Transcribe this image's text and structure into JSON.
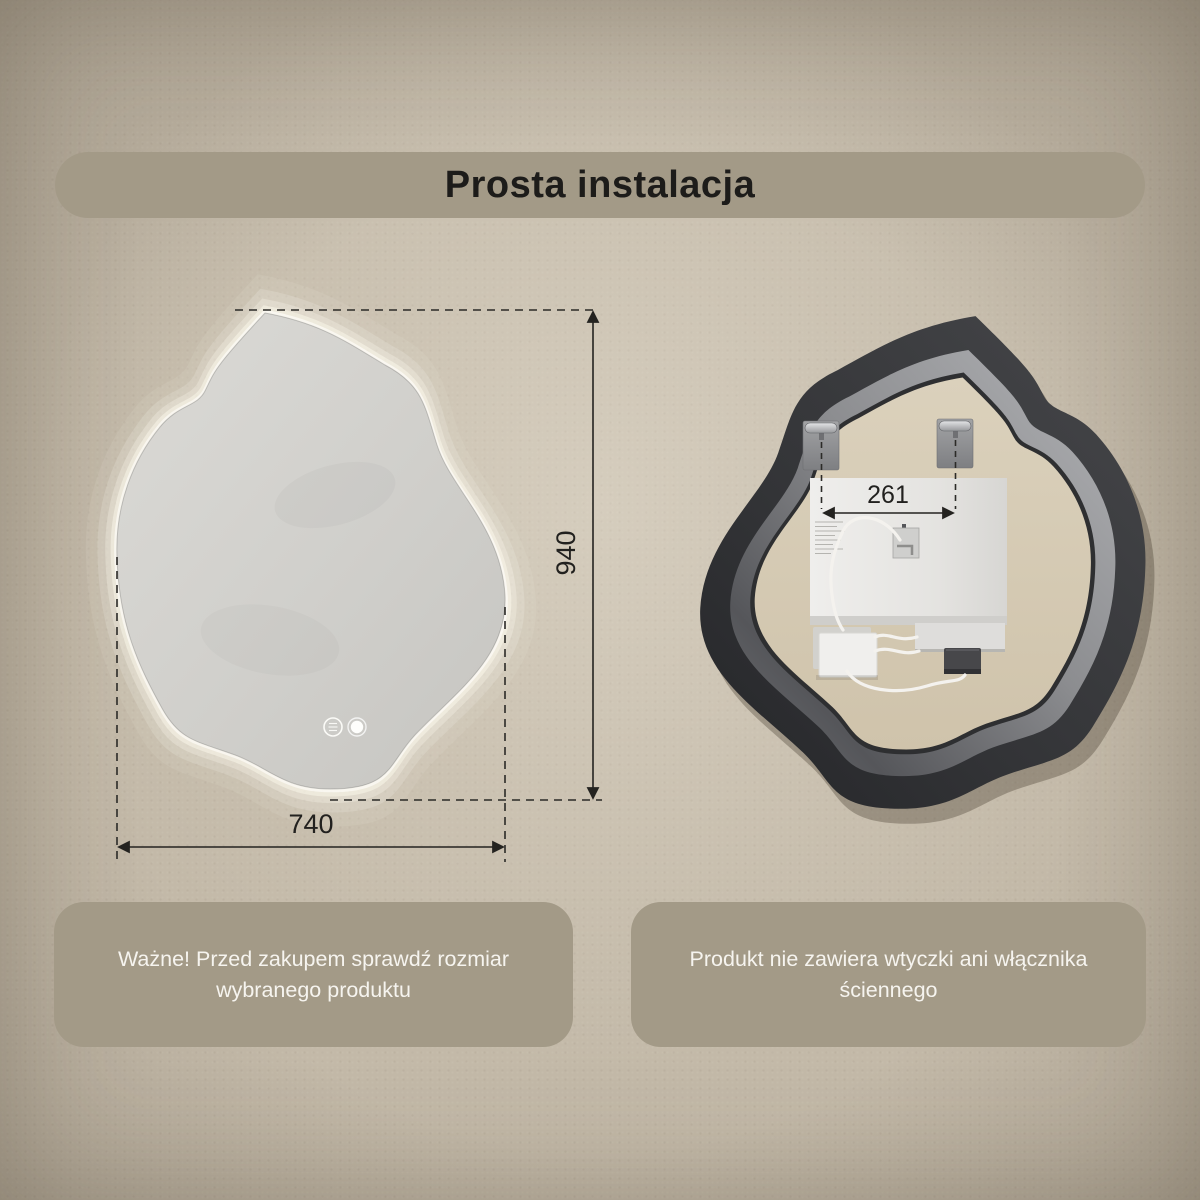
{
  "title": "Prosta instalacja",
  "front_view": {
    "height_label": "940",
    "width_label": "740",
    "touch_buttons": [
      {
        "icon": "antifog-touch-icon"
      },
      {
        "icon": "light-touch-icon"
      }
    ]
  },
  "back_view": {
    "bracket_distance_label": "261"
  },
  "info_boxes": [
    {
      "lines": [
        "Ważne! Przed zakupem sprawdź rozmiar",
        "wybranego produktu"
      ]
    },
    {
      "lines": [
        "Produkt nie zawiera wtyczki ani włącznika",
        "ściennego"
      ]
    }
  ],
  "colors": {
    "wall": "#c3b9a8",
    "banner": "#a39a87",
    "title_text": "#1d1c1a",
    "info_text": "#f6f4ef",
    "dimension_lines": "#242320",
    "mirror_surface": "#d5d4d0",
    "mirror_glow": "#fffef6",
    "frame_dark": "#38393b",
    "frame_metal": "#8f9094",
    "back_panel_beige": "#d6cbb4",
    "electronics_panel": "#e9e8e6"
  }
}
